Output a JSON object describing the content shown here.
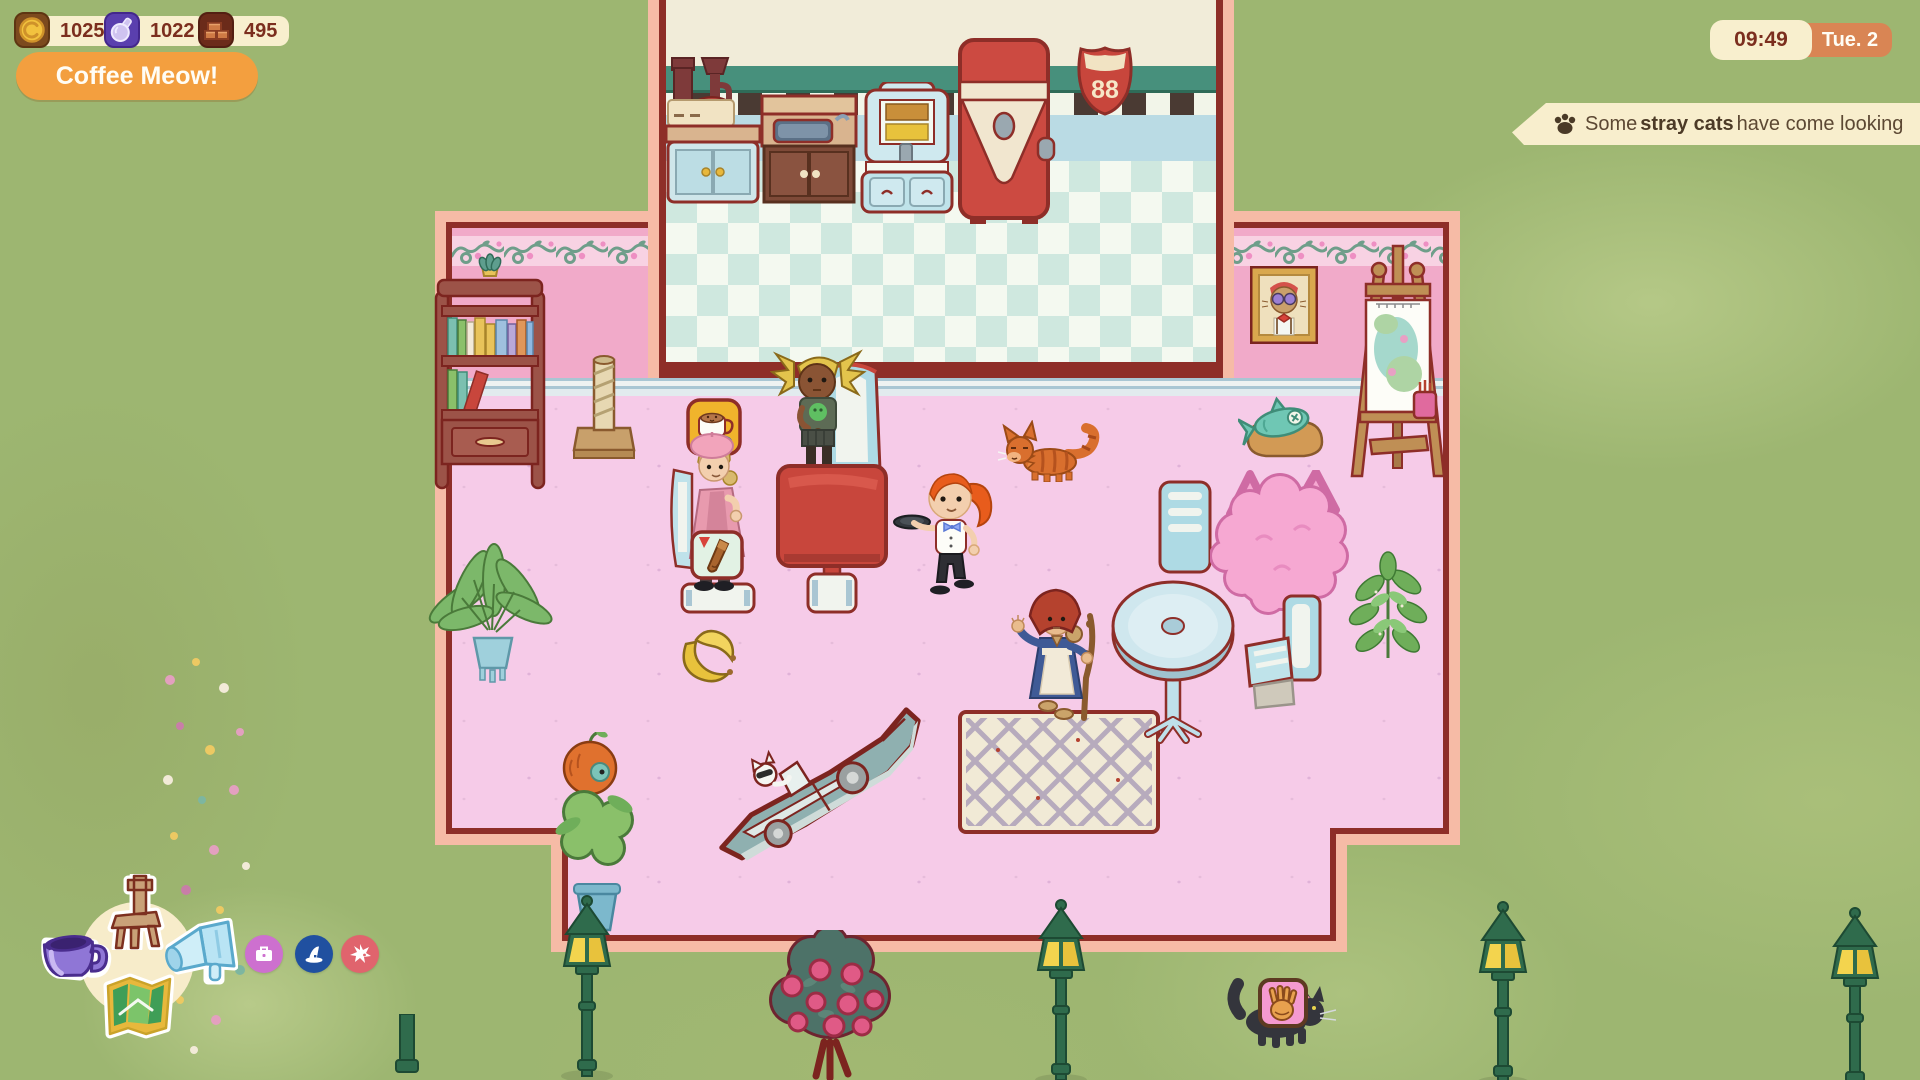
{
  "hud": {
    "currencies": [
      {
        "name": "gold",
        "icon": "coin-icon",
        "value": "1025"
      },
      {
        "name": "catnip",
        "icon": "potion-icon",
        "value": "1022"
      },
      {
        "name": "materials",
        "icon": "bricks-icon",
        "value": "495"
      }
    ],
    "play_button_label": "Coffee Meow!",
    "clock": {
      "time": "09:49",
      "day": "Tue. 2"
    }
  },
  "notification": {
    "icon": "paw-icon",
    "prefix": "Some ",
    "highlight": "stray cats",
    "suffix": " have come looking"
  },
  "menu": {
    "main_items": [
      {
        "name": "furniture",
        "icon": "chair-icon"
      },
      {
        "name": "drinks",
        "icon": "coffee-cup-icon"
      },
      {
        "name": "promote",
        "icon": "megaphone-icon"
      },
      {
        "name": "map",
        "icon": "map-icon"
      }
    ],
    "small_items": [
      {
        "name": "supplies",
        "icon": "briefcase-icon",
        "color": "#cd70cf"
      },
      {
        "name": "witchcraft",
        "icon": "witch-hat-icon",
        "color": "#2050a0"
      },
      {
        "name": "events",
        "icon": "burst-icon",
        "color": "#e0646d"
      }
    ]
  },
  "scene": {
    "route_sign": "88",
    "palette": {
      "grass": "#9db671",
      "floor_pink": "#f6cbe8",
      "wall_pink": "#f1aac9",
      "trim_salmon": "#f6bba6",
      "outline_maroon": "#8e2e28",
      "furniture_blue": "#aedae4",
      "accent_red": "#c8463c",
      "hud_cream": "#f8efce",
      "hud_orange": "#f39f3f",
      "hud_terracotta": "#d98554"
    }
  }
}
